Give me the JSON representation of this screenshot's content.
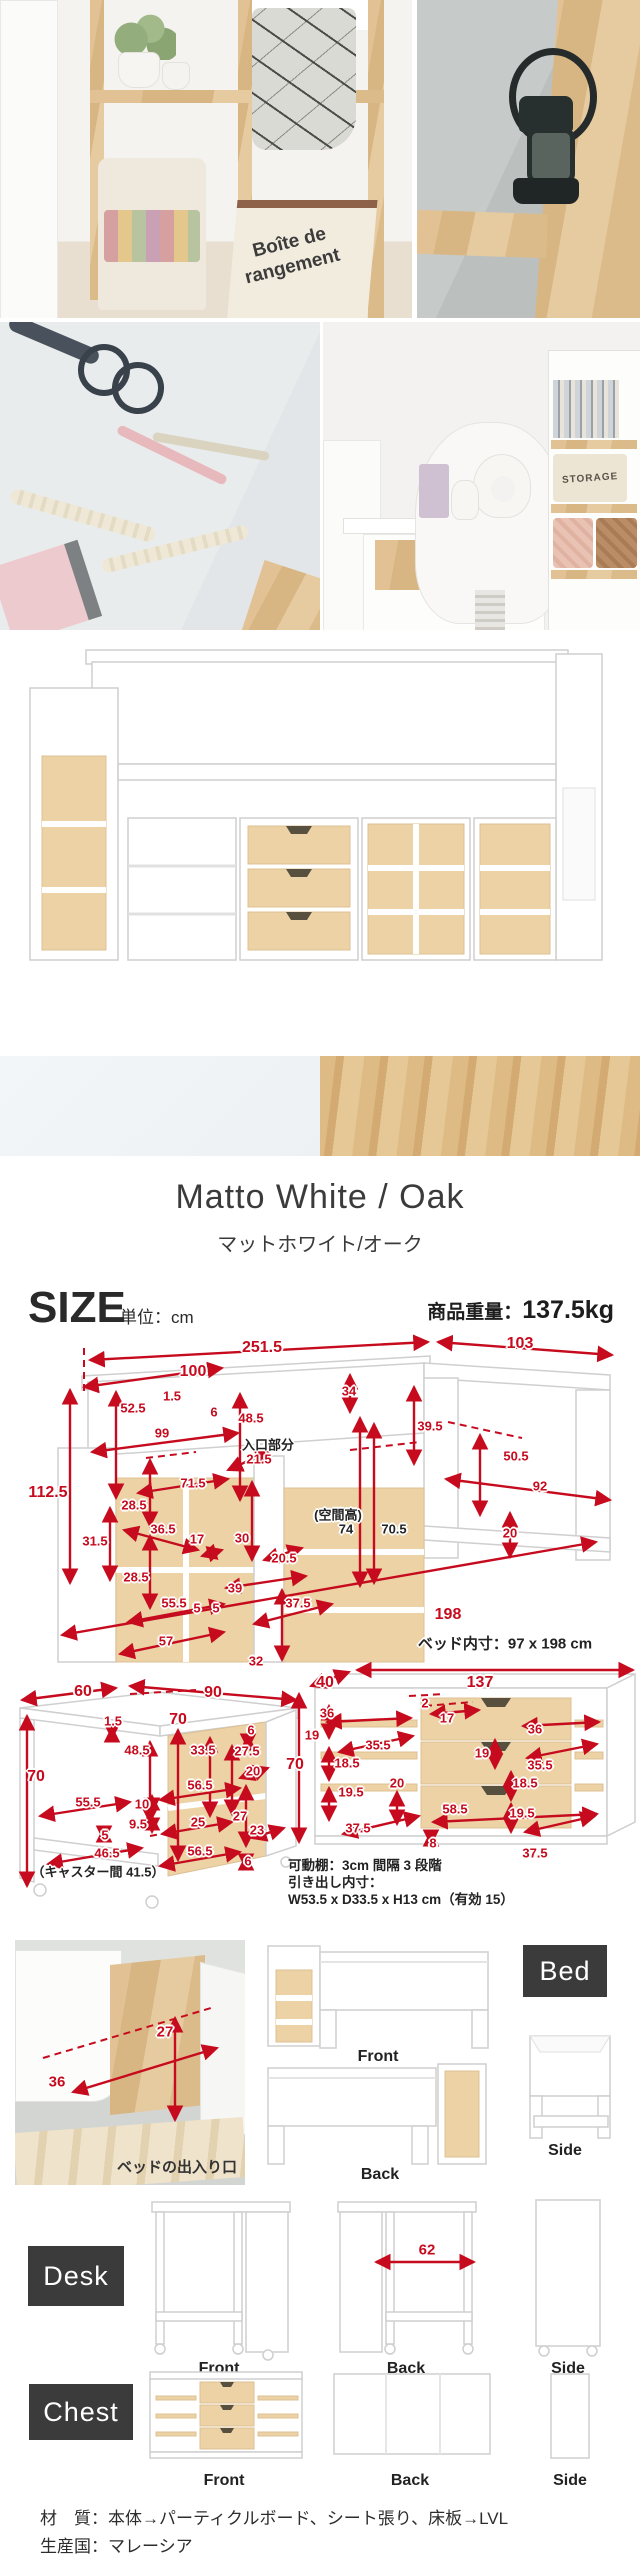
{
  "photos": {
    "bag_text_1": "Boîte de",
    "bag_text_2": "rangement",
    "storage_text": "STORAGE"
  },
  "swatch": {
    "title_en": "Matto White / Oak",
    "title_ja": "マットホワイト/オーク"
  },
  "size_header": {
    "label": "SIZE",
    "unit": "単位：cm",
    "weight_label": "商品重量：",
    "weight_value": "137.5kg"
  },
  "bed_diagram": {
    "dims": [
      {
        "v": "251.5",
        "x": 262,
        "y": 18,
        "c": "lg"
      },
      {
        "v": "103",
        "x": 520,
        "y": 14,
        "c": "lg"
      },
      {
        "v": "100",
        "x": 193,
        "y": 42,
        "c": "lg"
      },
      {
        "v": "1.5",
        "x": 172,
        "y": 66
      },
      {
        "v": "6",
        "x": 214,
        "y": 82
      },
      {
        "v": "52.5",
        "x": 133,
        "y": 78
      },
      {
        "v": "99",
        "x": 162,
        "y": 103
      },
      {
        "v": "48.5",
        "x": 251,
        "y": 88
      },
      {
        "v": "入口部分",
        "x": 268,
        "y": 114,
        "c": "dark"
      },
      {
        "v": "21.5",
        "x": 259,
        "y": 129
      },
      {
        "v": "71.5",
        "x": 193,
        "y": 153
      },
      {
        "v": "112.5",
        "x": 48,
        "y": 163,
        "c": "lg"
      },
      {
        "v": "34",
        "x": 349,
        "y": 61
      },
      {
        "v": "39.5",
        "x": 430,
        "y": 96
      },
      {
        "v": "50.5",
        "x": 516,
        "y": 126
      },
      {
        "v": "92",
        "x": 540,
        "y": 156
      },
      {
        "v": "(空間高)",
        "x": 338,
        "y": 184,
        "c": "dark"
      },
      {
        "v": "74",
        "x": 346,
        "y": 199,
        "c": "dark"
      },
      {
        "v": "70.5",
        "x": 394,
        "y": 199,
        "c": "dark"
      },
      {
        "v": "20",
        "x": 510,
        "y": 203
      },
      {
        "v": "198",
        "x": 448,
        "y": 285,
        "c": "lg"
      },
      {
        "v": "ベッド内寸：97 x 198 cm",
        "x": 505,
        "y": 313,
        "c": "note"
      },
      {
        "v": "28.5",
        "x": 134,
        "y": 175
      },
      {
        "v": "31.5",
        "x": 95,
        "y": 211
      },
      {
        "v": "36.5",
        "x": 163,
        "y": 199
      },
      {
        "v": "17",
        "x": 197,
        "y": 209
      },
      {
        "v": "30",
        "x": 242,
        "y": 208
      },
      {
        "v": "20.5",
        "x": 284,
        "y": 228
      },
      {
        "v": "28.5",
        "x": 136,
        "y": 247
      },
      {
        "v": "39",
        "x": 235,
        "y": 258
      },
      {
        "v": "55.5",
        "x": 174,
        "y": 273
      },
      {
        "v": "5",
        "x": 197,
        "y": 278
      },
      {
        "v": "5",
        "x": 216,
        "y": 278
      },
      {
        "v": "37.5",
        "x": 298,
        "y": 273
      },
      {
        "v": "57",
        "x": 166,
        "y": 311
      },
      {
        "v": "32",
        "x": 256,
        "y": 331
      }
    ]
  },
  "desk_diagram": {
    "dims": [
      {
        "v": "60",
        "x": 83,
        "y": 42,
        "c": "lg"
      },
      {
        "v": "90",
        "x": 213,
        "y": 43,
        "c": "lg"
      },
      {
        "v": "70",
        "x": 178,
        "y": 70,
        "c": "lg"
      },
      {
        "v": "1.5",
        "x": 113,
        "y": 71
      },
      {
        "v": "48.5",
        "x": 137,
        "y": 100
      },
      {
        "v": "70",
        "x": 36,
        "y": 127,
        "c": "lg"
      },
      {
        "v": "33.5",
        "x": 203,
        "y": 100
      },
      {
        "v": "6",
        "x": 251,
        "y": 80
      },
      {
        "v": "27.5",
        "x": 247,
        "y": 101
      },
      {
        "v": "20",
        "x": 253,
        "y": 121
      },
      {
        "v": "56.5",
        "x": 200,
        "y": 135
      },
      {
        "v": "55.5",
        "x": 88,
        "y": 152
      },
      {
        "v": "10",
        "x": 142,
        "y": 154
      },
      {
        "v": "9.5",
        "x": 138,
        "y": 174
      },
      {
        "v": "5",
        "x": 105,
        "y": 185
      },
      {
        "v": "25",
        "x": 198,
        "y": 172
      },
      {
        "v": "27",
        "x": 240,
        "y": 166
      },
      {
        "v": "23",
        "x": 257,
        "y": 180
      },
      {
        "v": "46.5",
        "x": 107,
        "y": 203
      },
      {
        "v": "56.5",
        "x": 200,
        "y": 201
      },
      {
        "v": "6",
        "x": 248,
        "y": 211
      },
      {
        "v": "（キャスター間 41.5）",
        "x": 98,
        "y": 221,
        "c": "dark"
      }
    ]
  },
  "chest_diagram": {
    "dims": [
      {
        "v": "40",
        "x": 40,
        "y": 35,
        "c": "lg"
      },
      {
        "v": "137",
        "x": 195,
        "y": 35,
        "c": "lg"
      },
      {
        "v": "70",
        "x": 10,
        "y": 117,
        "c": "lg"
      },
      {
        "v": "36",
        "x": 42,
        "y": 65
      },
      {
        "v": "19",
        "x": 27,
        "y": 87
      },
      {
        "v": "35.5",
        "x": 93,
        "y": 97
      },
      {
        "v": "18.5",
        "x": 62,
        "y": 115
      },
      {
        "v": "19.5",
        "x": 66,
        "y": 144
      },
      {
        "v": "37.5",
        "x": 73,
        "y": 180
      },
      {
        "v": "2",
        "x": 140,
        "y": 55
      },
      {
        "v": "17",
        "x": 162,
        "y": 70
      },
      {
        "v": "20",
        "x": 112,
        "y": 135
      },
      {
        "v": "58.5",
        "x": 170,
        "y": 161
      },
      {
        "v": "8",
        "x": 148,
        "y": 195
      },
      {
        "v": "36",
        "x": 250,
        "y": 81
      },
      {
        "v": "19",
        "x": 197,
        "y": 105
      },
      {
        "v": "35.5",
        "x": 255,
        "y": 117
      },
      {
        "v": "18.5",
        "x": 240,
        "y": 135
      },
      {
        "v": "19.5",
        "x": 237,
        "y": 165
      },
      {
        "v": "37.5",
        "x": 250,
        "y": 205
      }
    ],
    "note_line1": "可動棚：3cm 間隔 3 段階",
    "note_line2": "引き出し内寸：",
    "note_line3": "W53.5 x D33.5 x H13 cm（有効 15）"
  },
  "views": {
    "bed": {
      "tag": "Bed",
      "front": "Front",
      "back": "Back",
      "side": "Side",
      "entry_caption": "ベッドの出入り口",
      "entry_height": "27",
      "entry_width": "36"
    },
    "desk": {
      "tag": "Desk",
      "front": "Front",
      "back": "Back",
      "side": "Side",
      "back_width": "62"
    },
    "chest": {
      "tag": "Chest",
      "front": "Front",
      "back": "Back",
      "side": "Side"
    }
  },
  "footer": {
    "line1": "材　質：本体→パーティクルボード、シート張り、床板→LVL",
    "line2": "生産国：マレーシア"
  }
}
